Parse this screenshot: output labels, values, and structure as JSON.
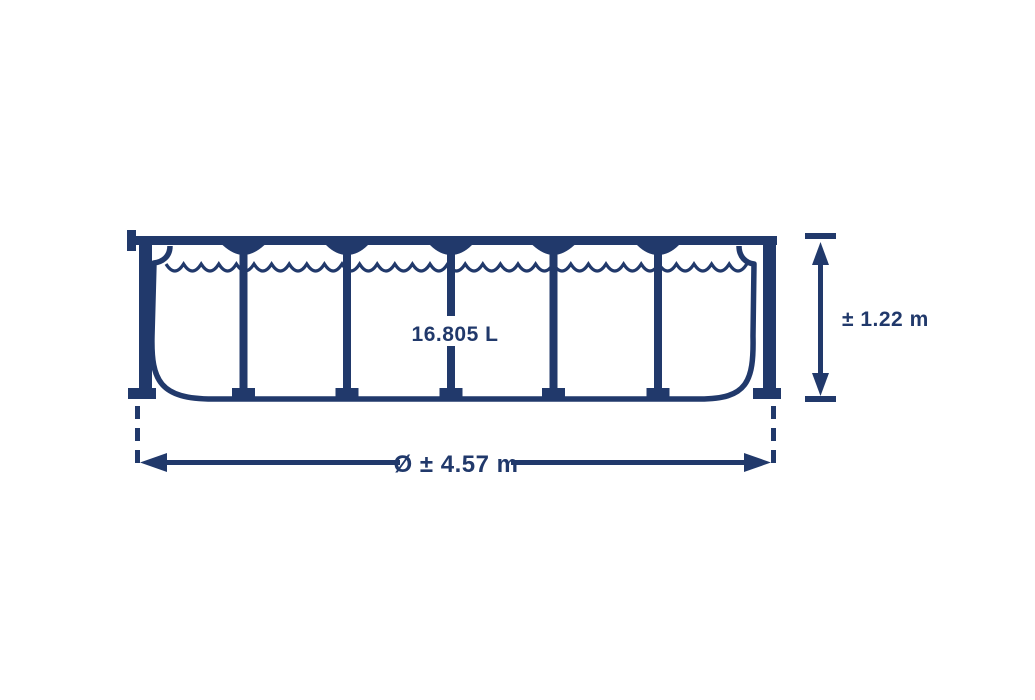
{
  "diagram": {
    "capacity_label": "16.805 L",
    "height_label": "± 1.22 m",
    "diameter_label": "Ø ± 4.57 m"
  },
  "colors": {
    "line": "#21396b",
    "background": "#ffffff"
  }
}
